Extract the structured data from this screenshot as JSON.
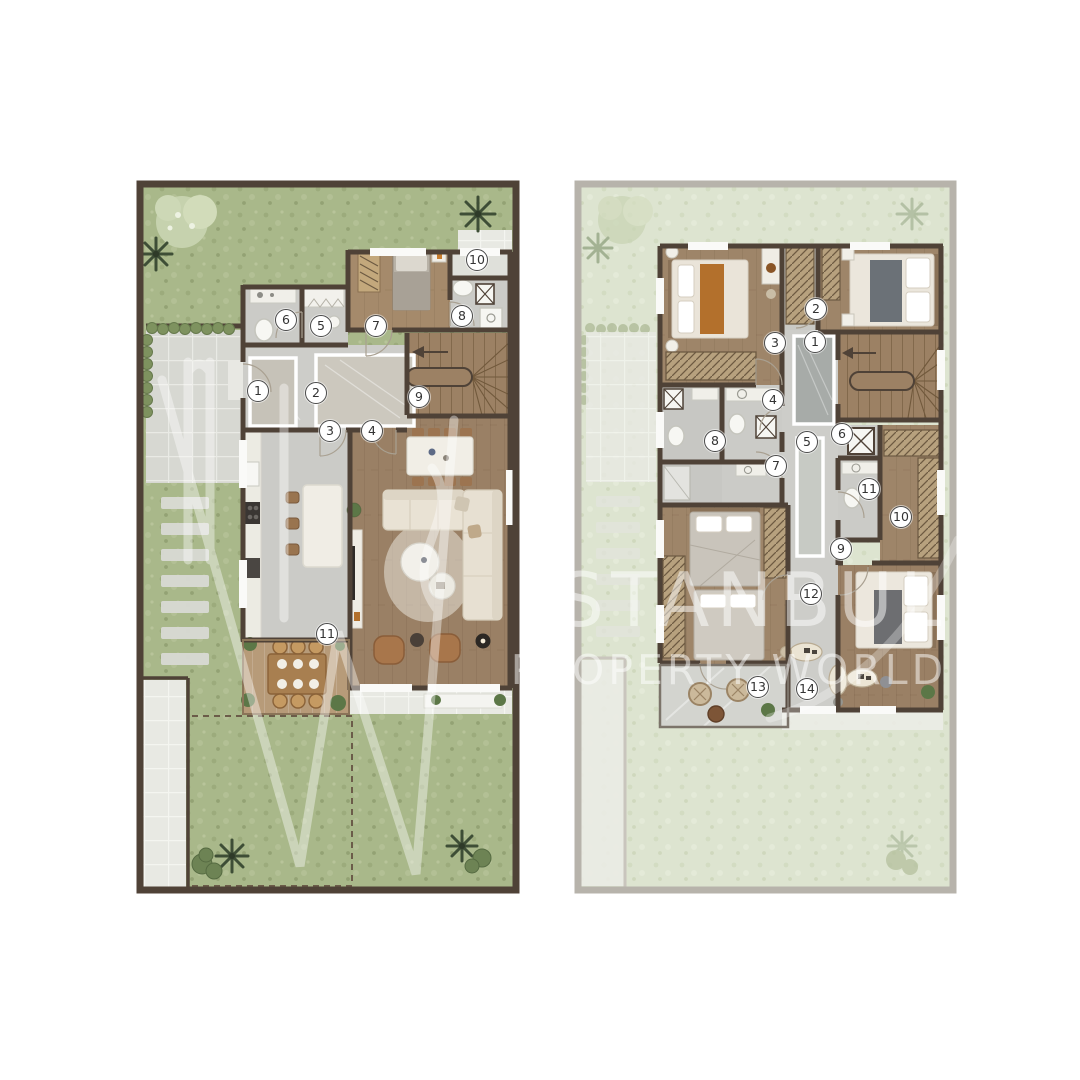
{
  "image": {
    "kind": "real-estate floor plan rendering",
    "background": "#ffffff"
  },
  "watermark": {
    "line1": "ISTANBUL",
    "line2": "PROPERTY WORLD",
    "color": "#ffffff"
  },
  "palette": {
    "garden_green": "#a9b88a",
    "garden_pale": "#dde4d0",
    "wall_dark": "#4f4237",
    "wall_pale": "#b7b3ab",
    "floor_stone": "#cbcbc7",
    "floor_wood": "#9e8468",
    "deck_wood": "#b79b79",
    "tile_light": "#d7d8d2",
    "tile_pale": "#e8e9e3",
    "furniture_cream": "#efece4",
    "accent_orange": "#b3702c",
    "plant_green": "#5c7747",
    "marker_bg": "#ffffff",
    "marker_border": "#4a4a4a",
    "marker_text": "#333333"
  },
  "plans": [
    {
      "id": "ground-floor",
      "markers": [
        {
          "n": "1",
          "x": 258,
          "y": 391
        },
        {
          "n": "2",
          "x": 316,
          "y": 393
        },
        {
          "n": "3",
          "x": 330,
          "y": 431
        },
        {
          "n": "4",
          "x": 372,
          "y": 431
        },
        {
          "n": "5",
          "x": 321,
          "y": 326
        },
        {
          "n": "6",
          "x": 286,
          "y": 320
        },
        {
          "n": "7",
          "x": 376,
          "y": 326
        },
        {
          "n": "8",
          "x": 462,
          "y": 316
        },
        {
          "n": "9",
          "x": 419,
          "y": 397
        },
        {
          "n": "10",
          "x": 477,
          "y": 260
        },
        {
          "n": "11",
          "x": 327,
          "y": 634
        }
      ]
    },
    {
      "id": "first-floor",
      "markers": [
        {
          "n": "1",
          "x": 815,
          "y": 342
        },
        {
          "n": "2",
          "x": 816,
          "y": 309
        },
        {
          "n": "3",
          "x": 775,
          "y": 343
        },
        {
          "n": "4",
          "x": 773,
          "y": 400
        },
        {
          "n": "5",
          "x": 807,
          "y": 442
        },
        {
          "n": "6",
          "x": 842,
          "y": 434
        },
        {
          "n": "7",
          "x": 776,
          "y": 466
        },
        {
          "n": "8",
          "x": 715,
          "y": 441
        },
        {
          "n": "9",
          "x": 841,
          "y": 549
        },
        {
          "n": "10",
          "x": 901,
          "y": 517
        },
        {
          "n": "11",
          "x": 869,
          "y": 489
        },
        {
          "n": "12",
          "x": 811,
          "y": 594
        },
        {
          "n": "13",
          "x": 758,
          "y": 687
        },
        {
          "n": "14",
          "x": 807,
          "y": 689
        }
      ]
    }
  ]
}
